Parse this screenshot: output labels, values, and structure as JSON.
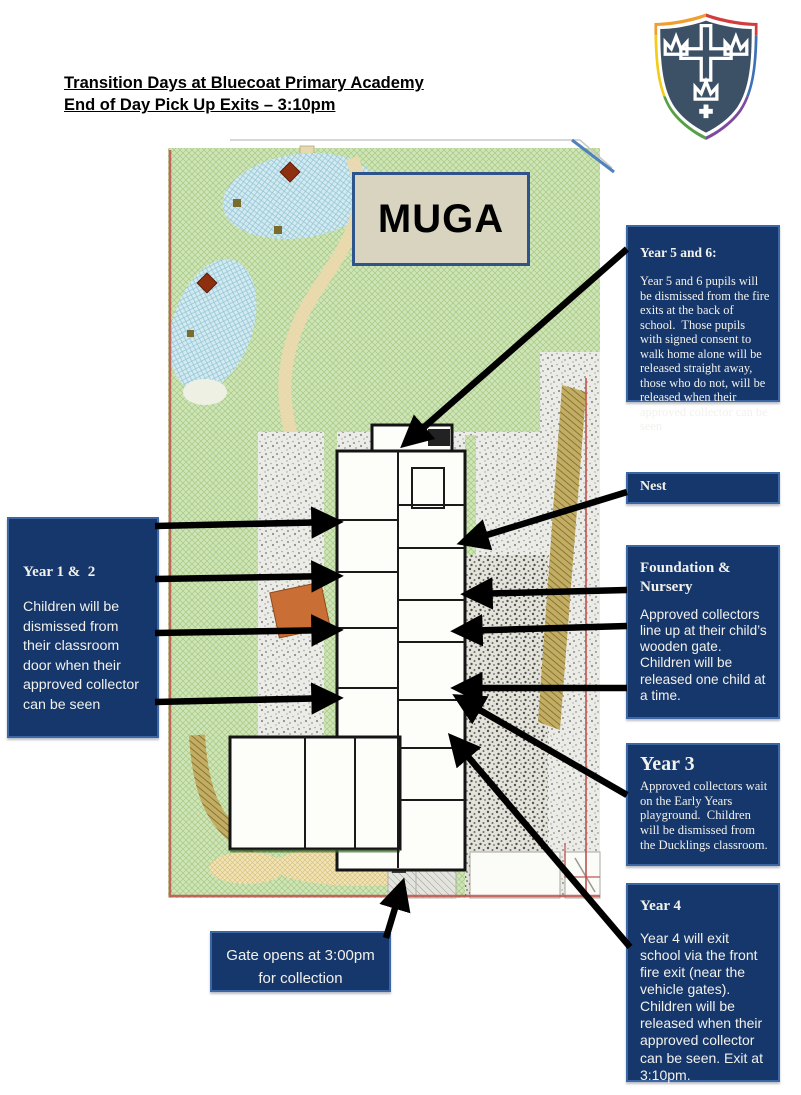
{
  "header": {
    "title_line1": "Transition Days at Bluecoat Primary Academy",
    "title_line2": "End of Day Pick Up Exits – 3:10pm"
  },
  "map": {
    "muga_label": "MUGA"
  },
  "callouts": {
    "year56": {
      "title": "Year 5 and 6:",
      "body": "Year 5 and 6 pupils will be dismissed from the fire exits at the back of school.  Those pupils with signed consent to walk home alone will be released straight away, those who do not, will be released when their approved collector can be seen"
    },
    "nest": {
      "title": "Nest"
    },
    "foundation": {
      "title": "Foundation &\nNursery",
      "body": "Approved collectors line up at their child’s wooden gate.\nChildren will be released one child at a time."
    },
    "year3": {
      "title": "Year 3",
      "body": "Approved collectors wait on the Early Years playground.  Children will be dismissed from the Ducklings classroom."
    },
    "year4": {
      "title": "Year 4",
      "body": "Year 4 will exit school via the front fire exit (near the vehicle gates). Children will be released when their approved collector can be seen. Exit at 3:10pm."
    },
    "year12": {
      "title": "Year 1 &  2",
      "body": "Children will be dismissed from their classroom door when their approved collector can be seen"
    },
    "gate": {
      "body": "Gate opens at 3:00pm\nfor collection"
    }
  },
  "colors": {
    "callout_navy": "#16376b",
    "callout_border": "#3c66a4",
    "muga_fill": "#d9d4c0",
    "map_grass": "#cfe5b8",
    "arrow": "#000000"
  },
  "arrows": [
    {
      "name": "year56-to-rear-fire-exit",
      "x1": 627,
      "y1": 249,
      "x2": 406,
      "y2": 443
    },
    {
      "name": "nest-to-building",
      "x1": 627,
      "y1": 492,
      "x2": 464,
      "y2": 542
    },
    {
      "name": "foundation-gate-1",
      "x1": 627,
      "y1": 590,
      "x2": 468,
      "y2": 594
    },
    {
      "name": "foundation-gate-2",
      "x1": 627,
      "y1": 626,
      "x2": 458,
      "y2": 631
    },
    {
      "name": "foundation-gate-3",
      "x1": 627,
      "y1": 688,
      "x2": 458,
      "y2": 688
    },
    {
      "name": "year3-to-ducklings",
      "x1": 627,
      "y1": 795,
      "x2": 459,
      "y2": 698
    },
    {
      "name": "year4-to-front-fire-exit",
      "x1": 630,
      "y1": 947,
      "x2": 453,
      "y2": 739
    },
    {
      "name": "year12-door-1",
      "x1": 155,
      "y1": 526,
      "x2": 336,
      "y2": 522
    },
    {
      "name": "year12-door-2",
      "x1": 155,
      "y1": 579,
      "x2": 336,
      "y2": 576
    },
    {
      "name": "year12-door-3",
      "x1": 155,
      "y1": 633,
      "x2": 336,
      "y2": 630
    },
    {
      "name": "year12-door-4",
      "x1": 155,
      "y1": 702,
      "x2": 336,
      "y2": 698
    },
    {
      "name": "gate-arrow",
      "x1": 386,
      "y1": 938,
      "x2": 402,
      "y2": 885
    }
  ]
}
